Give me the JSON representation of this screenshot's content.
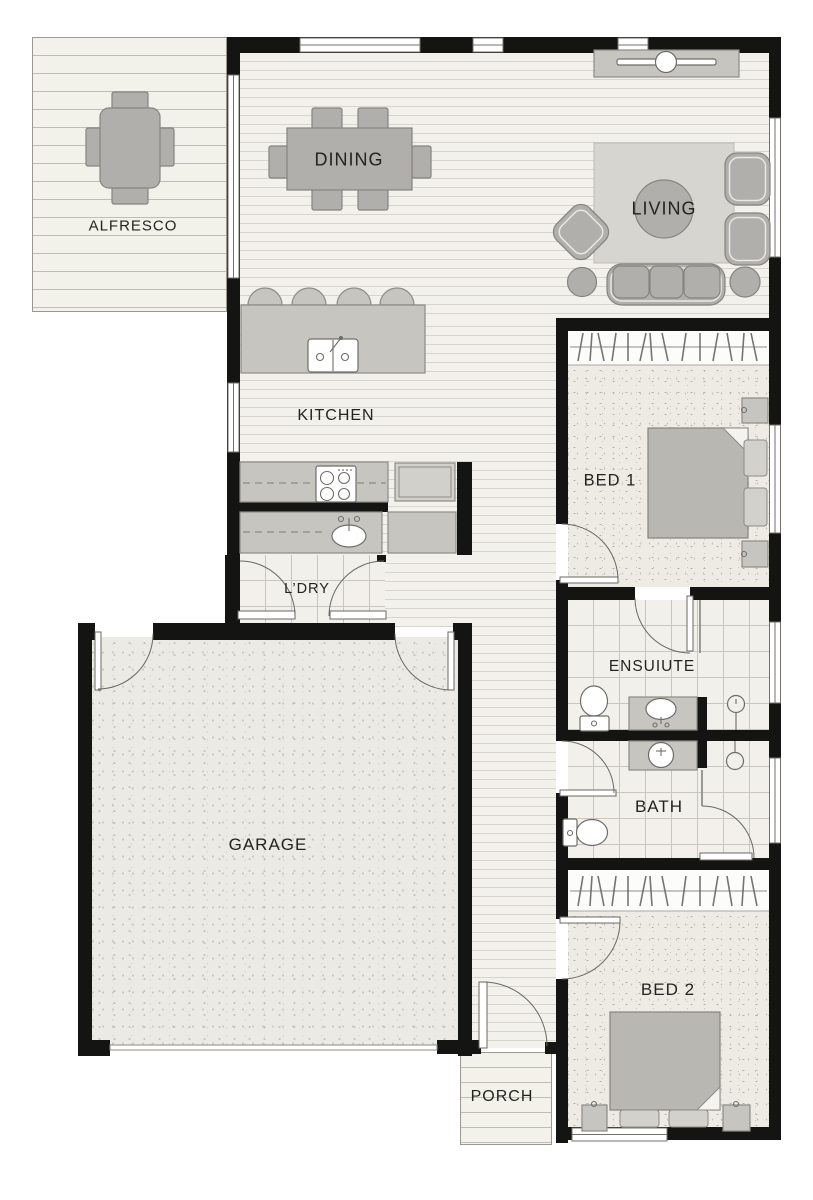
{
  "plan": {
    "title": "house-floor-plan",
    "rooms": {
      "alfresco": {
        "label": "ALFRESCO"
      },
      "dining": {
        "label": "DINING"
      },
      "living": {
        "label": "LIVING"
      },
      "kitchen": {
        "label": "KITCHEN"
      },
      "laundry": {
        "label": "L’DRY"
      },
      "bed1": {
        "label": "BED 1"
      },
      "ensuite": {
        "label": "ENSUIUTE"
      },
      "bath": {
        "label": "BATH"
      },
      "garage": {
        "label": "GARAGE"
      },
      "bed2": {
        "label": "BED 2"
      },
      "porch": {
        "label": "PORCH"
      }
    },
    "colors": {
      "wall": "#141412",
      "floor_base": "#f2f1eb",
      "floorboard_line": "#d7d5ce",
      "carpet": "#edebe4",
      "tile": "#f1f0ea",
      "concrete": "#ebeae5",
      "furniture": "#b1afab",
      "bench": "#c7c5c0",
      "rug": "#d7d5d0",
      "text": "#232321"
    }
  }
}
